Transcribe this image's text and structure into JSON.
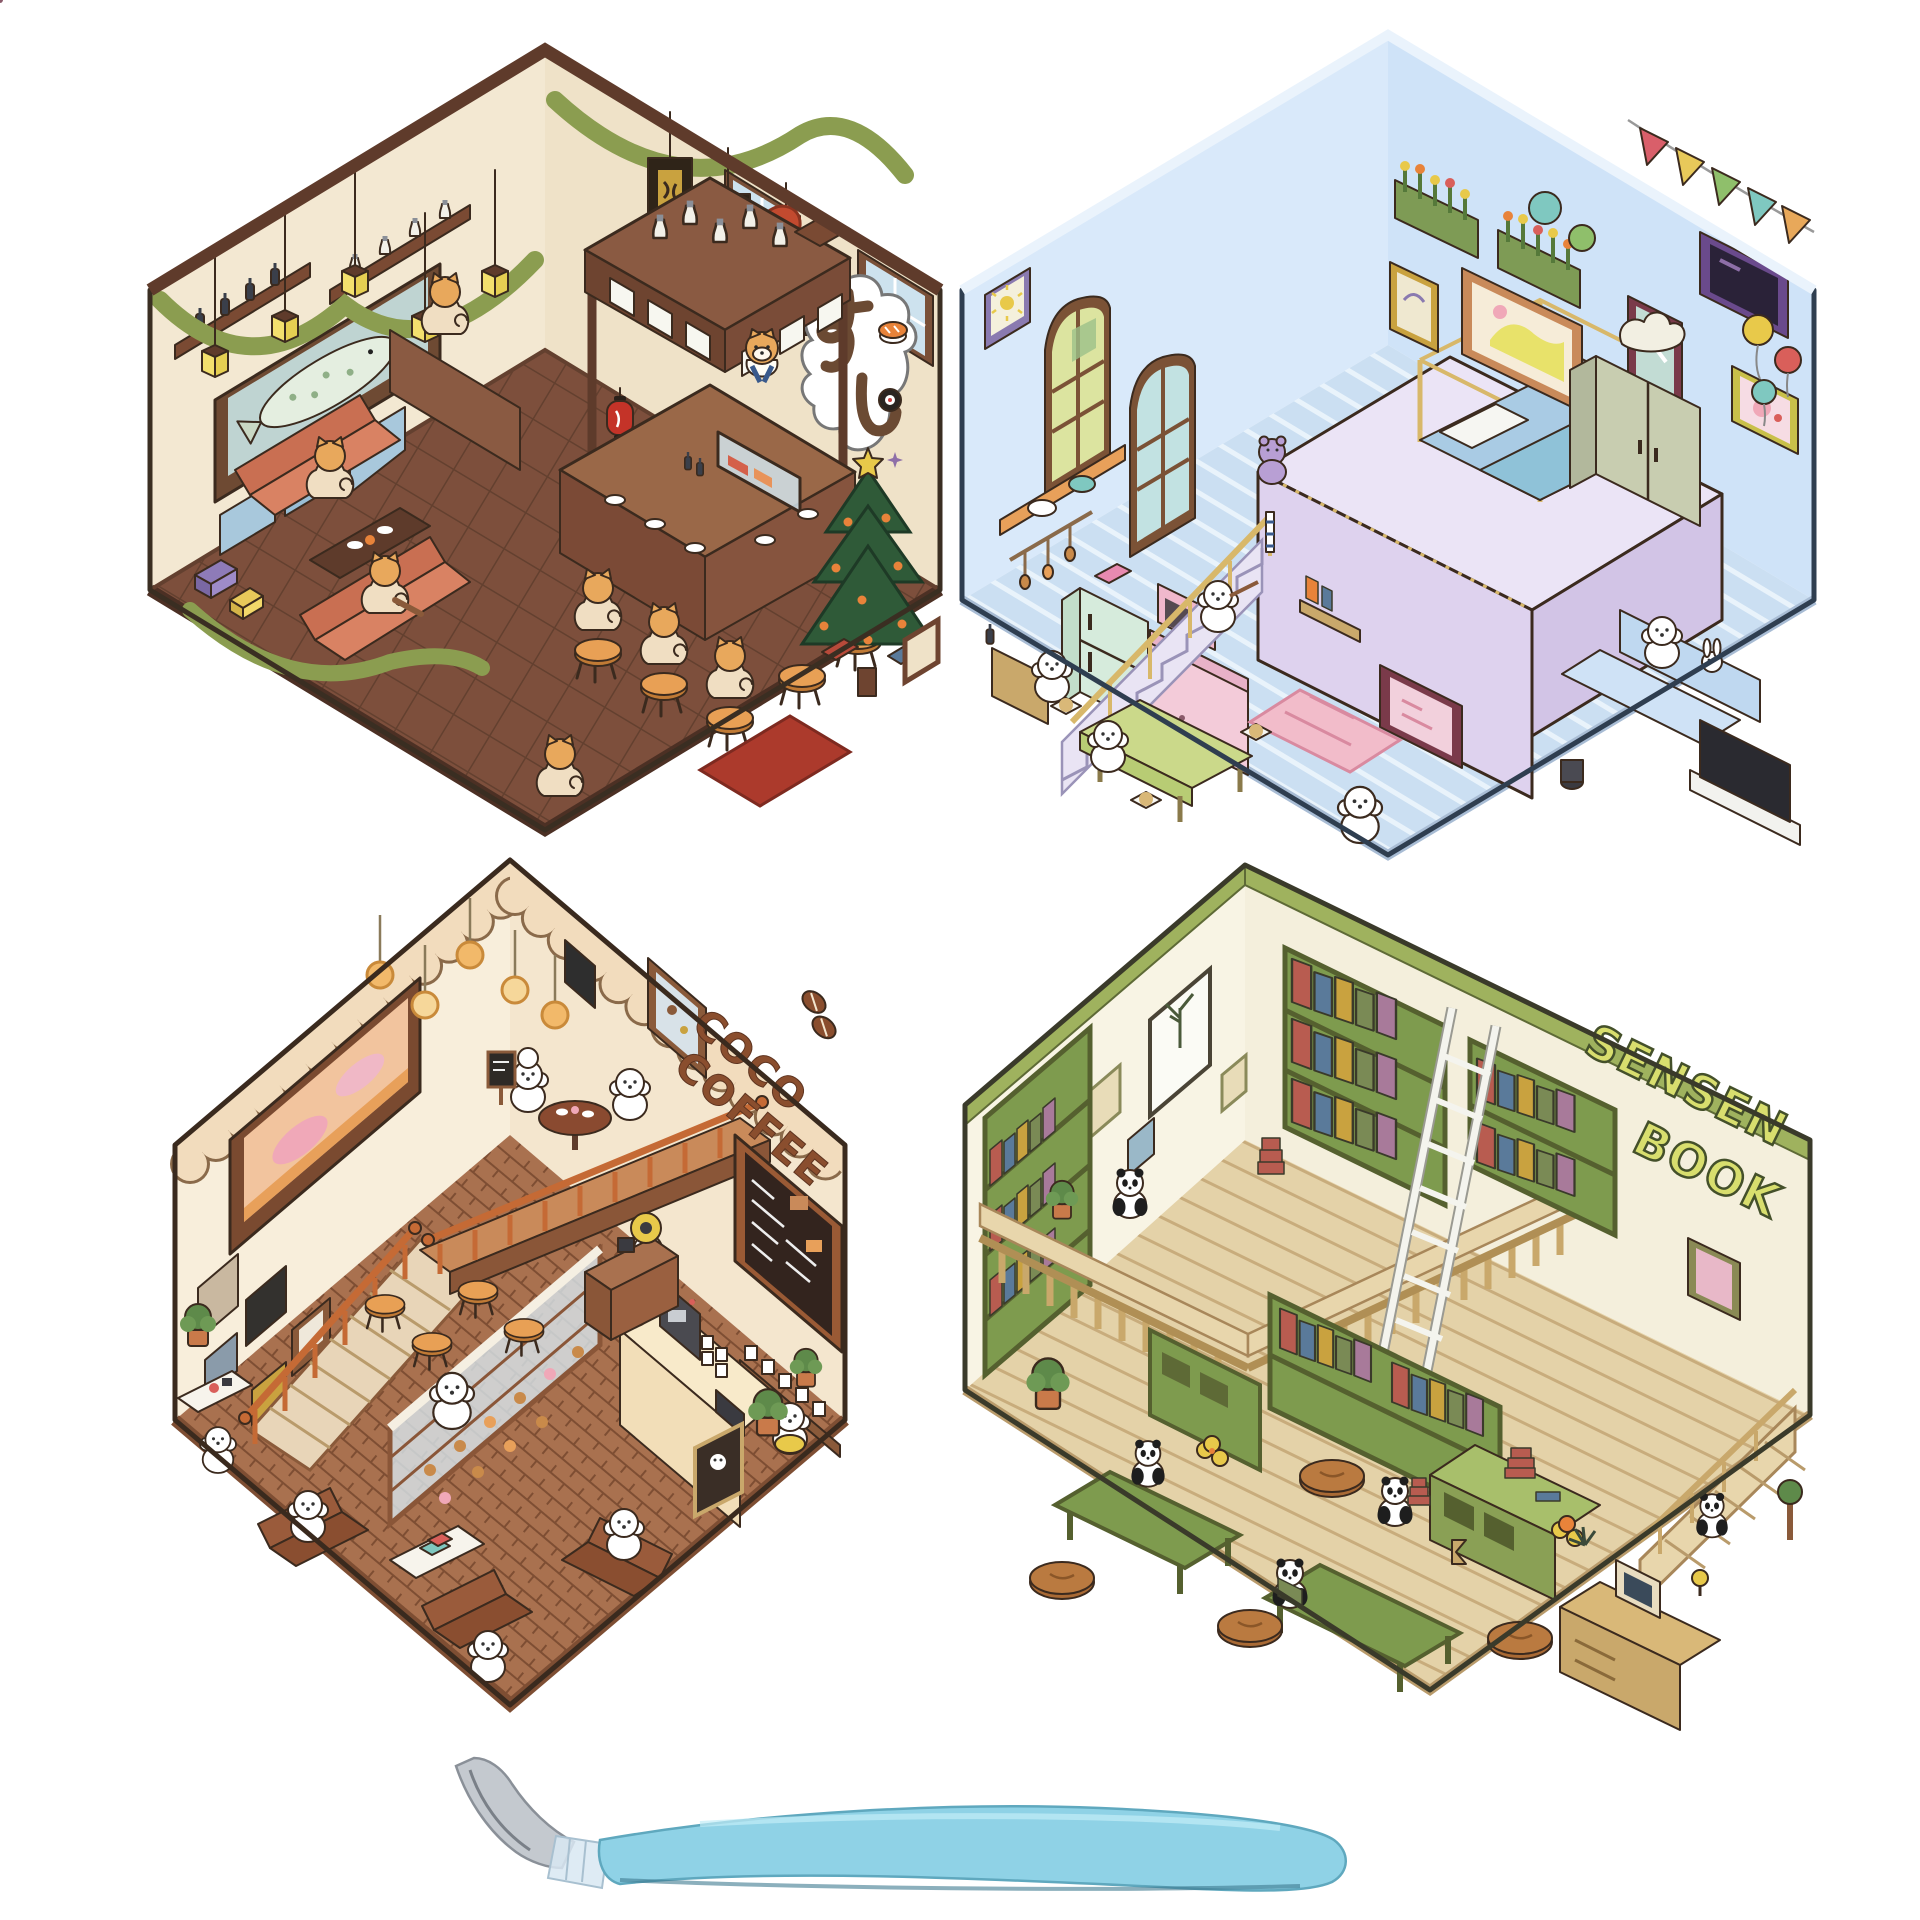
{
  "product": {
    "background": "#FFFFFF",
    "scene_count": 4,
    "tool": {
      "name": "tweezers",
      "handle_color": "#8FD2E6",
      "tip_color": "#C4C9CF"
    }
  },
  "scenes": {
    "sushi_restaurant": {
      "sign_text": "すし",
      "palette": {
        "wall": "#F3E8D2",
        "floor": "#7D4F3C",
        "trim": "#5F3B2B",
        "garland": "#8B9D50",
        "lantern": "#F3E06E",
        "sofa": "#C96F52",
        "red_lantern": "#C43328",
        "tree": "#2F5A38"
      }
    },
    "bedroom": {
      "palette": {
        "wall": "#D9E9FA",
        "floor": "#CBDFF2",
        "loft": "#DED2EE",
        "fridge": "#D6EBDC",
        "kitchen": "#F3CBD9",
        "table": "#CBD98A",
        "sofa": "#BFD8F0"
      }
    },
    "coffee_shop": {
      "sign_line1": "COCO",
      "sign_line2": "COFFEE",
      "sign_color": "#8A4E2E",
      "palette": {
        "wall": "#F8EEDB",
        "floor": "#A9714F",
        "valance": "#F2DCBD",
        "railing": "#C56A35",
        "armchair": "#9A5B3B",
        "counter": "#F2DEB8"
      }
    },
    "bookstore": {
      "sign_line1": "SENSEN",
      "sign_line2": "BOOK",
      "sign_color": "#D8DE6E",
      "palette": {
        "wall": "#F8F4E4",
        "floor": "#E4D2A8",
        "shelf": "#7E9B4E",
        "trim": "#9FB25E",
        "wood": "#C9A86B"
      }
    }
  }
}
